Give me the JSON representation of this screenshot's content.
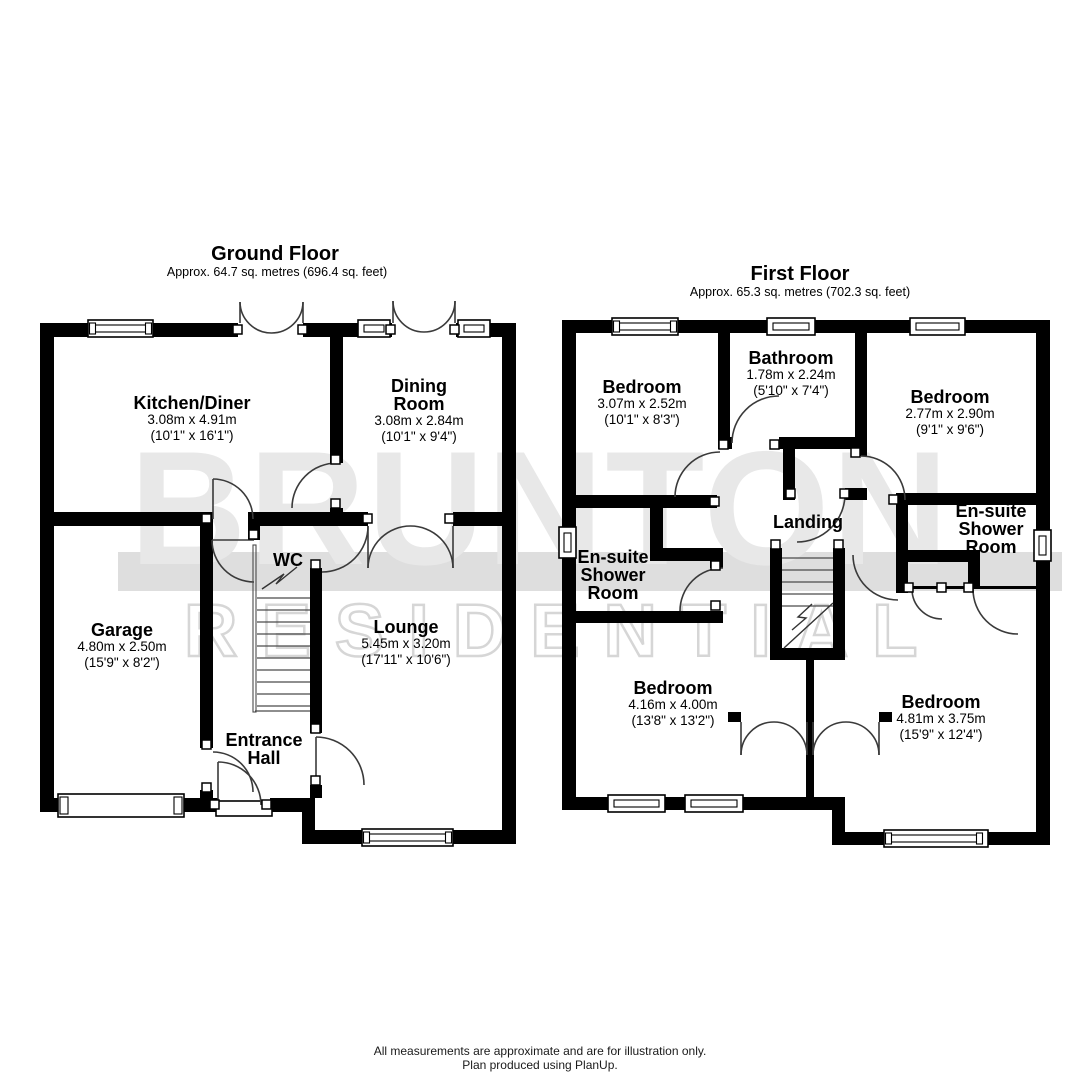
{
  "watermark": {
    "line1": "BRUNTON",
    "line2": "RESIDENTIAL"
  },
  "colors": {
    "wall": "#000000",
    "watermark_text": "#e8e8e8",
    "watermark_band": "#dedede"
  },
  "ground_floor": {
    "title": "Ground Floor",
    "subtitle": "Approx. 64.7 sq. metres (696.4 sq. feet)",
    "rooms": {
      "kitchen": {
        "name": "Kitchen/Diner",
        "dim_m": "3.08m x 4.91m",
        "dim_ft": "(10'1\" x 16'1\")"
      },
      "dining": {
        "name": "Dining\nRoom",
        "dim_m": "3.08m x 2.84m",
        "dim_ft": "(10'1\" x 9'4\")"
      },
      "garage": {
        "name": "Garage",
        "dim_m": "4.80m x 2.50m",
        "dim_ft": "(15'9\" x 8'2\")"
      },
      "wc": {
        "name": "WC"
      },
      "lounge": {
        "name": "Lounge",
        "dim_m": "5.45m x 3.20m",
        "dim_ft": "(17'11\" x 10'6\")"
      },
      "hall": {
        "name": "Entrance\nHall"
      }
    }
  },
  "first_floor": {
    "title": "First Floor",
    "subtitle": "Approx. 65.3 sq. metres (702.3 sq. feet)",
    "rooms": {
      "bed_tl": {
        "name": "Bedroom",
        "dim_m": "3.07m x 2.52m",
        "dim_ft": "(10'1\" x 8'3\")"
      },
      "bathroom": {
        "name": "Bathroom",
        "dim_m": "1.78m x 2.24m",
        "dim_ft": "(5'10\" x 7'4\")"
      },
      "bed_tr": {
        "name": "Bedroom",
        "dim_m": "2.77m x 2.90m",
        "dim_ft": "(9'1\" x 9'6\")"
      },
      "ensuite_left": {
        "name": "En-suite\nShower\nRoom"
      },
      "ensuite_right": {
        "name": "En-suite\nShower\nRoom"
      },
      "landing": {
        "name": "Landing"
      },
      "bed_bl": {
        "name": "Bedroom",
        "dim_m": "4.16m x 4.00m",
        "dim_ft": "(13'8\" x 13'2\")"
      },
      "bed_br": {
        "name": "Bedroom",
        "dim_m": "4.81m x 3.75m",
        "dim_ft": "(15'9\" x 12'4\")"
      }
    }
  },
  "footer": {
    "line1": "All measurements are approximate and are for illustration only.",
    "line2": "Plan produced using PlanUp."
  }
}
